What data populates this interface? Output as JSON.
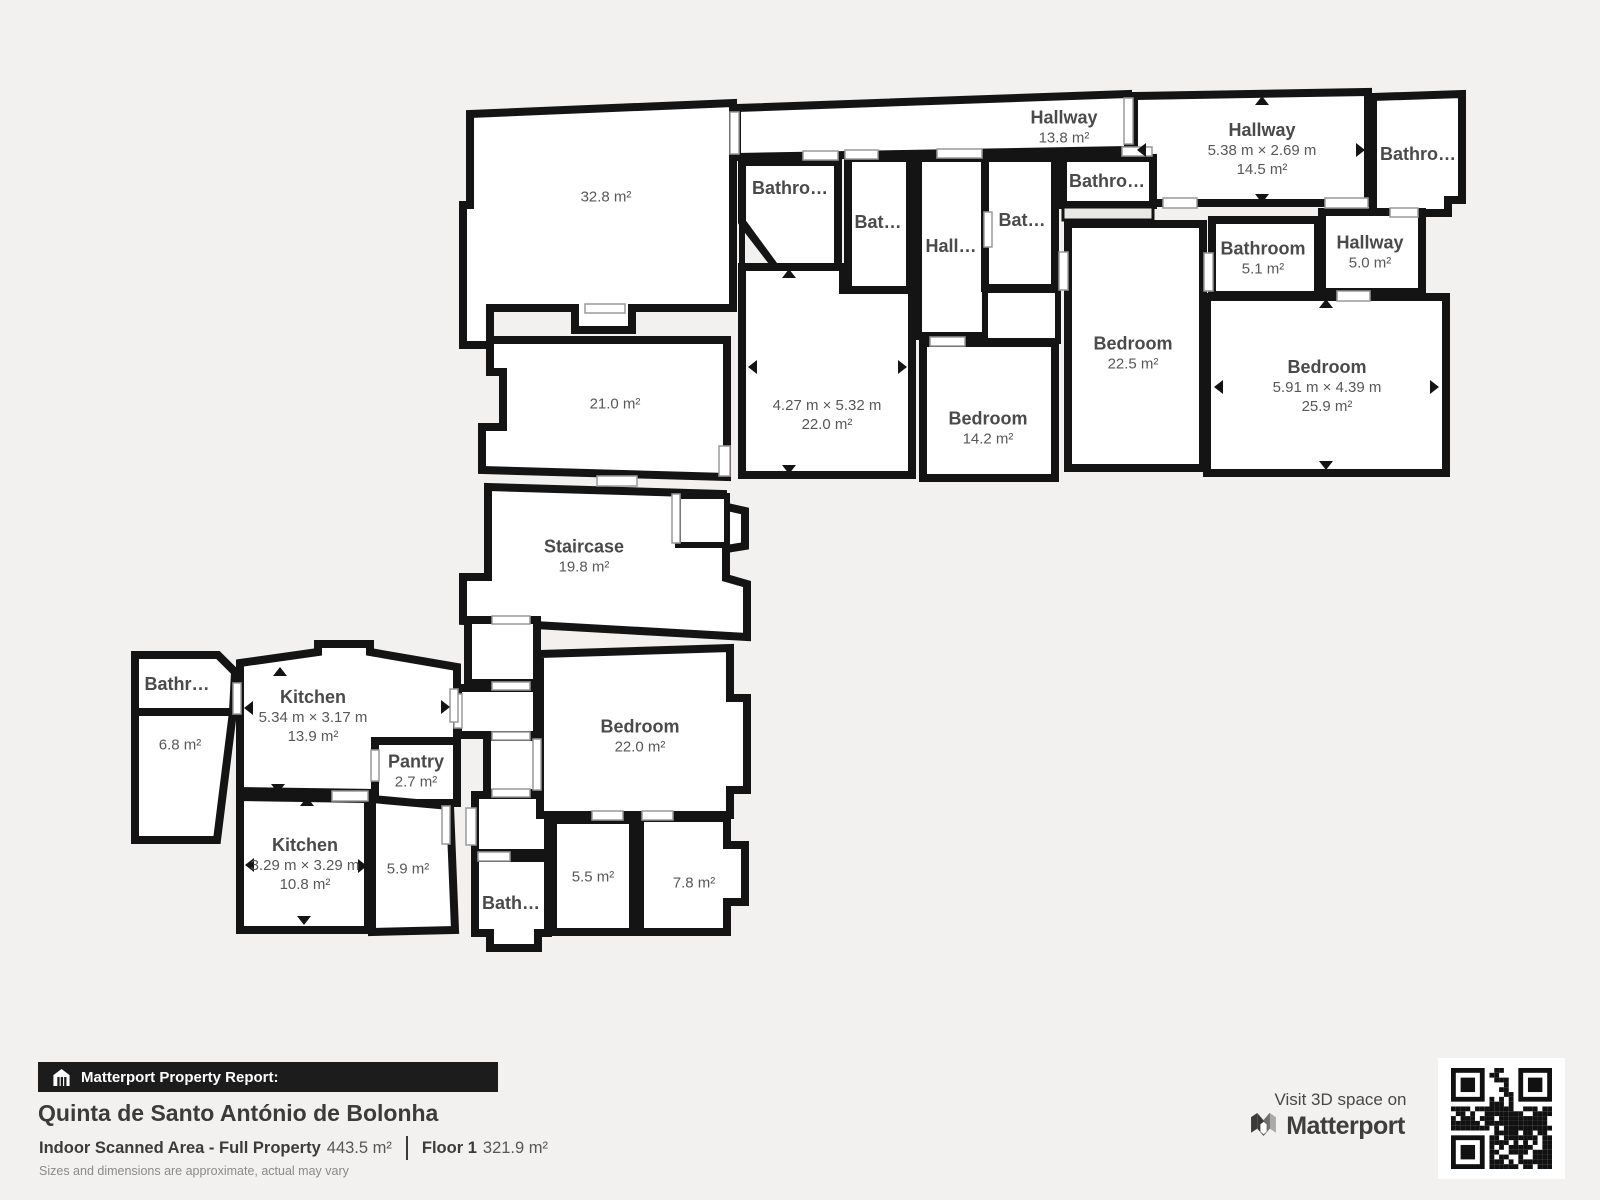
{
  "colors": {
    "background": "#f2f1ef",
    "wall": "#141414",
    "room_fill": "#ffffff",
    "label_text": "#4a4a4a",
    "bar_background": "#1c1c1c"
  },
  "rooms": [
    {
      "id": "hallway-a",
      "name": "Hallway",
      "area": "13.8 m²"
    },
    {
      "id": "hallway-b",
      "name": "Hallway",
      "dims": "5.38 m × 2.69 m",
      "area": "14.5 m²"
    },
    {
      "id": "bathroom-tr",
      "name": "Bathro…"
    },
    {
      "id": "bathroom-m1",
      "name": "Bathro…"
    },
    {
      "id": "bathroom-m2",
      "name": "Bat…"
    },
    {
      "id": "hall-small",
      "name": "Hall…"
    },
    {
      "id": "bathroom-m3",
      "name": "Bat…"
    },
    {
      "id": "bathroom-m4",
      "name": "Bathro…"
    },
    {
      "id": "room-32-8",
      "area": "32.8 m²"
    },
    {
      "id": "room-21-0",
      "area": "21.0 m²"
    },
    {
      "id": "staircase",
      "name": "Staircase",
      "area": "19.8 m²"
    },
    {
      "id": "room-22-0a",
      "dims": "4.27 m × 5.32 m",
      "area": "22.0 m²"
    },
    {
      "id": "bedroom-14-2",
      "name": "Bedroom",
      "area": "14.2 m²"
    },
    {
      "id": "bedroom-22-5",
      "name": "Bedroom",
      "area": "22.5 m²"
    },
    {
      "id": "bathroom-5-1",
      "name": "Bathroom",
      "area": "5.1 m²"
    },
    {
      "id": "hallway-5-0",
      "name": "Hallway",
      "area": "5.0 m²"
    },
    {
      "id": "bedroom-25-9",
      "name": "Bedroom",
      "dims": "5.91 m × 4.39 m",
      "area": "25.9 m²"
    },
    {
      "id": "bathr-small",
      "name": "Bathr…"
    },
    {
      "id": "room-6-8",
      "area": "6.8 m²"
    },
    {
      "id": "kitchen-a",
      "name": "Kitchen",
      "dims": "5.34 m × 3.17 m",
      "area": "13.9 m²"
    },
    {
      "id": "pantry",
      "name": "Pantry",
      "area": "2.7 m²"
    },
    {
      "id": "kitchen-b",
      "name": "Kitchen",
      "dims": "3.29 m × 3.29 m",
      "area": "10.8 m²"
    },
    {
      "id": "room-5-9",
      "area": "5.9 m²"
    },
    {
      "id": "bath-small",
      "name": "Bath…"
    },
    {
      "id": "room-5-5",
      "area": "5.5 m²"
    },
    {
      "id": "room-7-8",
      "area": "7.8 m²"
    },
    {
      "id": "bedroom-22-0b",
      "name": "Bedroom",
      "area": "22.0 m²"
    }
  ],
  "footer": {
    "report_label": "Matterport Property Report:",
    "property_name": "Quinta de Santo António de Bolonha",
    "scanned_area_label": "Indoor Scanned Area - Full Property",
    "scanned_area_value": "443.5 m²",
    "floor_label": "Floor 1",
    "floor_value": "321.9 m²",
    "disclaimer": "Sizes and dimensions are approximate, actual may vary"
  },
  "branding": {
    "visit_text": "Visit 3D space on",
    "brand_name": "Matterport"
  }
}
